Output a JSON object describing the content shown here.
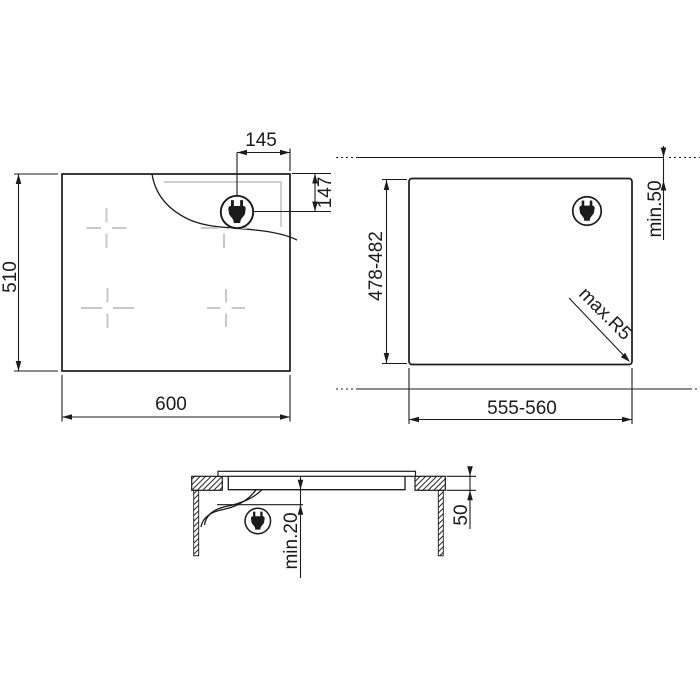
{
  "diagram": {
    "top_view": {
      "width_label": "600",
      "height_label": "510",
      "plug_from_right_label": "145",
      "plug_from_top_label": "147"
    },
    "cutout_view": {
      "width_label": "555-560",
      "depth_label": "478-482",
      "rear_clearance_label": "min.50",
      "corner_radius_label": "max.R5"
    },
    "section_view": {
      "below_clearance_label": "min.20",
      "worktop_thickness_label": "50"
    },
    "icons": {
      "plug": "power-plug-icon"
    },
    "colors": {
      "line": "#1b1b1b",
      "light_gray": "#c8c8c8",
      "background": "#ffffff"
    }
  }
}
